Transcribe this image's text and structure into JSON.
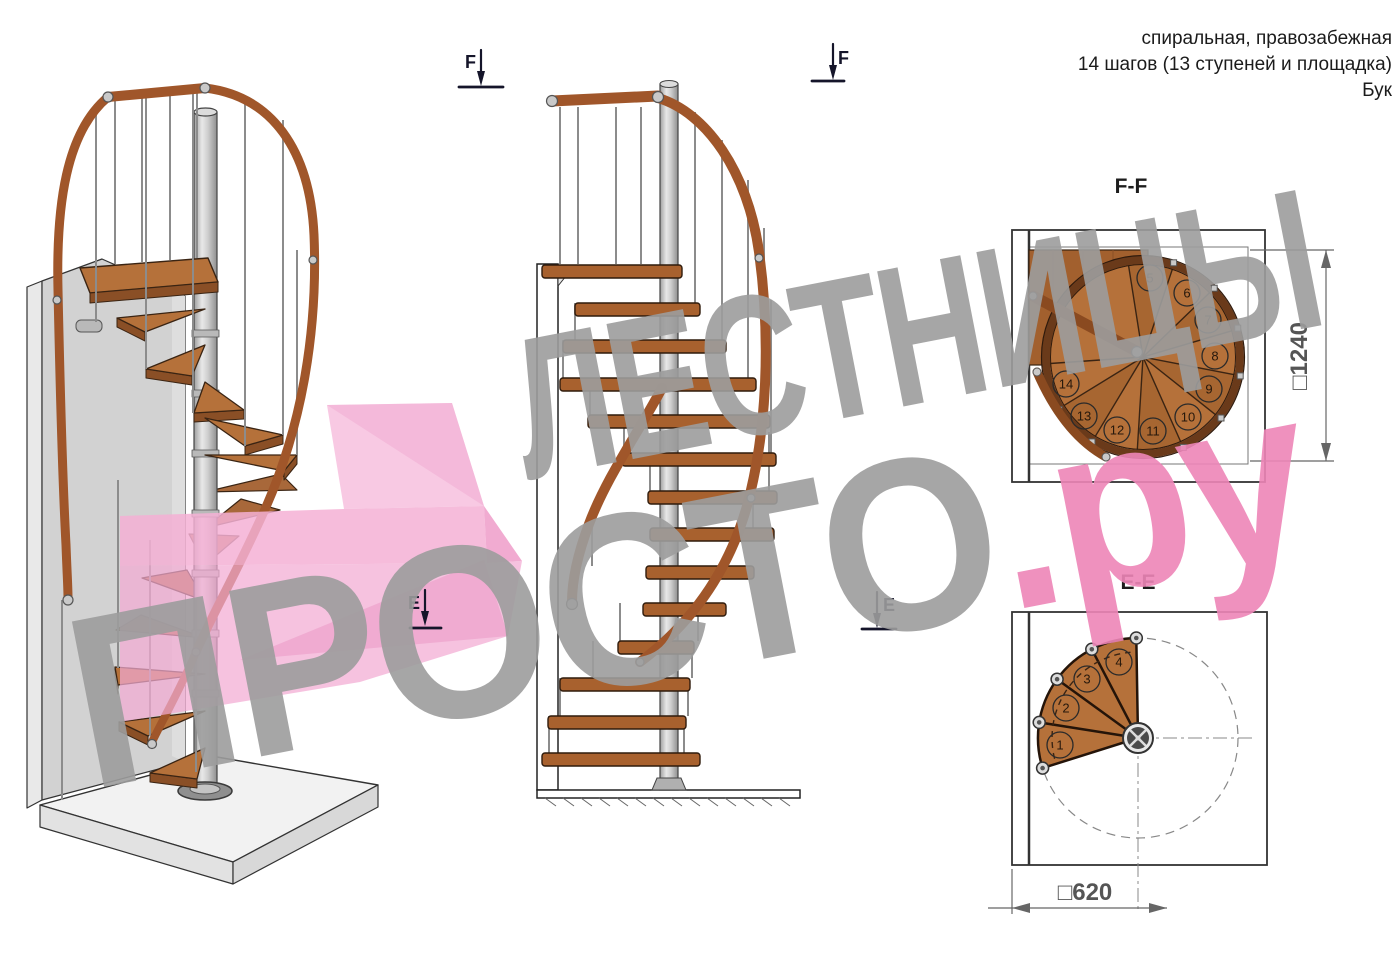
{
  "header": {
    "line1": "спиральная, правозабежная",
    "line2": "14 шагов (13 ступеней и площадка)",
    "line3": "Бук"
  },
  "watermark": {
    "line1": "ЛЕСТНИЦЫ",
    "line2_gray": "ПРОСТО",
    "line2_pink": ".ру",
    "gray_color": "#9d9d9d",
    "pink_color": "#ee86b8"
  },
  "sections": {
    "ff": {
      "title": "F-F",
      "dimension": "□1240",
      "steps": [
        "5",
        "6",
        "7",
        "8",
        "9",
        "10",
        "11",
        "12",
        "13",
        "14"
      ]
    },
    "ee": {
      "title": "E-E",
      "dimension": "□620",
      "steps": [
        "1",
        "2",
        "3",
        "4"
      ]
    }
  },
  "markers": {
    "f": "F",
    "e": "E"
  },
  "colors": {
    "wood": "#b5713a",
    "wood_dark": "#8a4f26",
    "handrail": "#a0562a",
    "steel": "#c9c9c9",
    "arrow_pink": "#f4b0d5",
    "line": "#222222"
  }
}
